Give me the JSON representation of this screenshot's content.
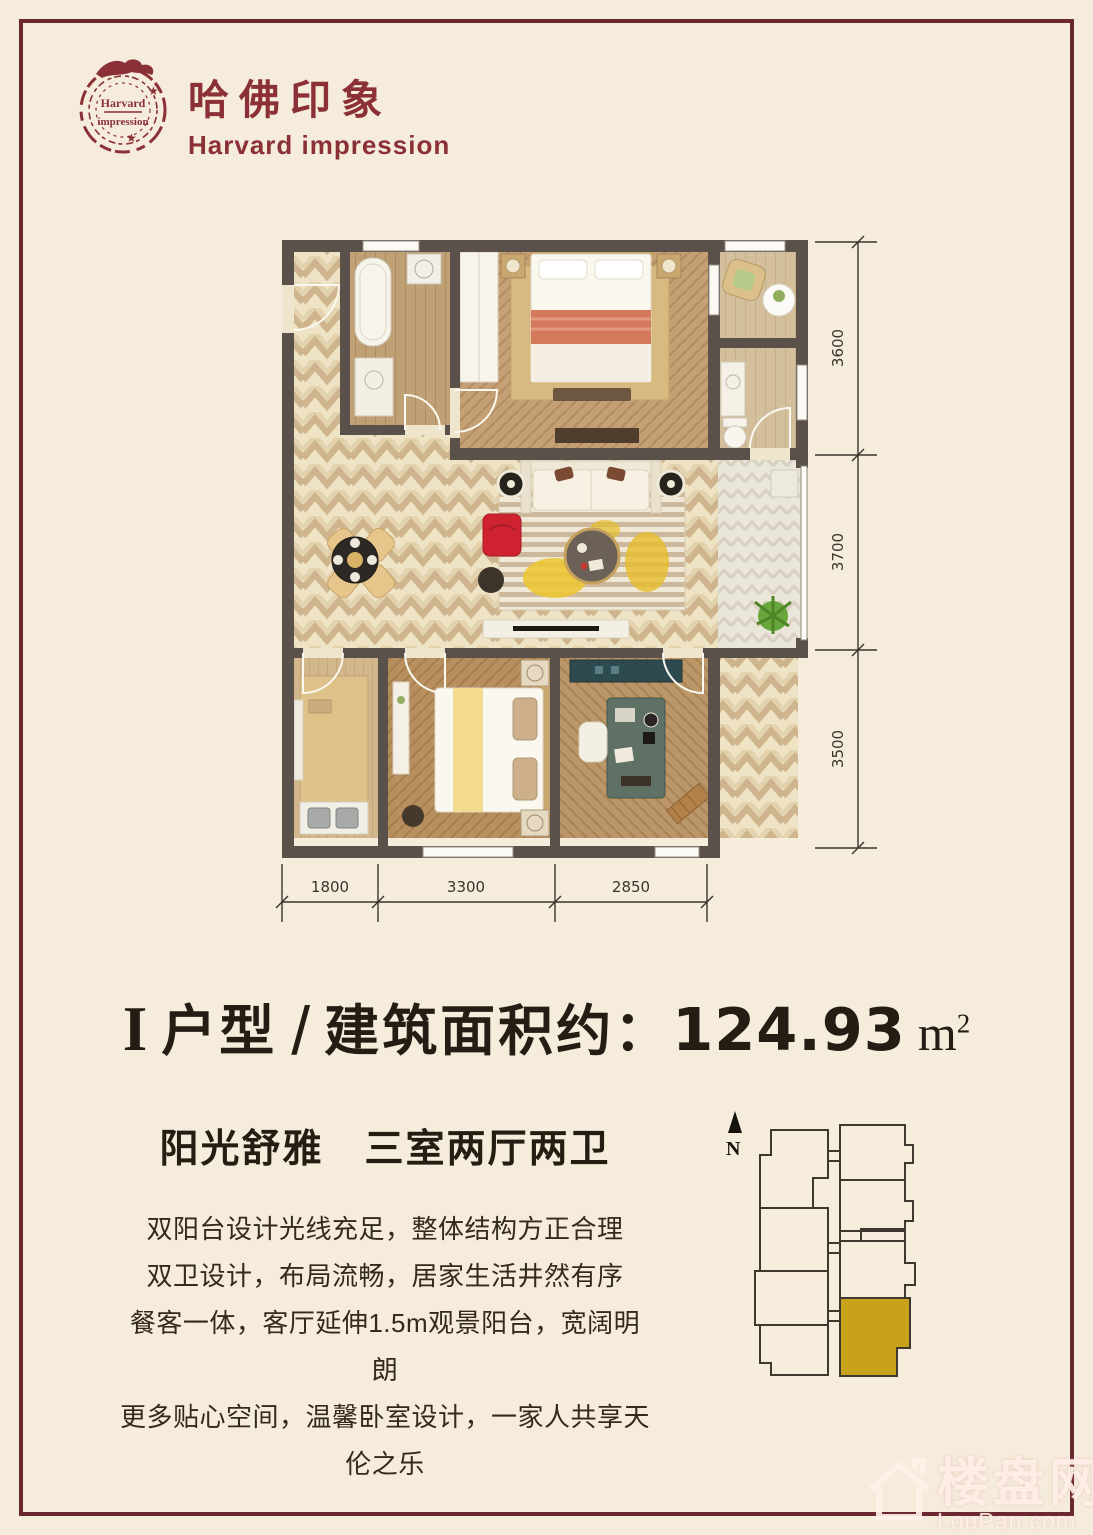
{
  "page": {
    "background": "#f5ecdc",
    "frame_color": "#6b2831"
  },
  "brand": {
    "stamp_top": "Harvard",
    "stamp_bottom": "impression",
    "name_cn": "哈佛印象",
    "name_en": "Harvard impression",
    "color": "#8c3038"
  },
  "plan": {
    "wall_color": "#59514a",
    "dims_right": [
      "3600",
      "3700",
      "3500"
    ],
    "dims_bottom": [
      "1800",
      "3300",
      "2850"
    ]
  },
  "title": {
    "unit": "I",
    "type_label": "户型",
    "slash": "/",
    "area_label": "建筑面积约：",
    "area_value": "124.93",
    "unit_m": "m",
    "unit_sup": "2"
  },
  "subtitle": "阳光舒雅　三室两厅两卫",
  "description": [
    "双阳台设计光线充足，整体结构方正合理",
    "双卫设计，布局流畅，居家生活井然有序",
    "餐客一体，客厅延伸1.5m观景阳台，宽阔明朗",
    "更多贴心空间，温馨卧室设计，一家人共享天伦之乐"
  ],
  "keyplan": {
    "north": "N",
    "highlight": "#c9a21b"
  },
  "watermark": {
    "cn": "楼盘网",
    "en": "LouPan.com"
  }
}
